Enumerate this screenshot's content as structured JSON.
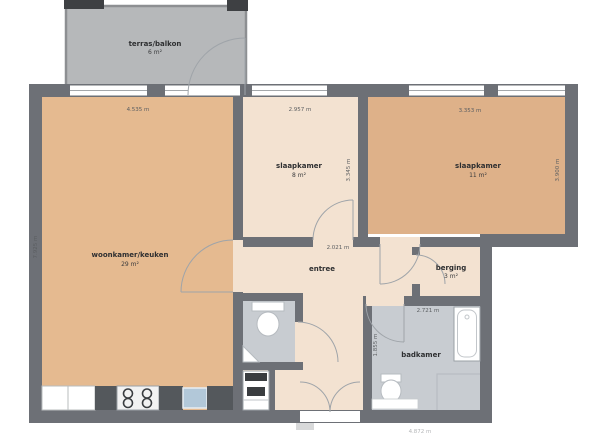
{
  "title": "apartment floor plan",
  "colors": {
    "wall": "#6d7076",
    "balcony_fill": "#b6b8ba",
    "balcony_stroke": "#8d8f92",
    "stub": "#3e4043",
    "living_floor": "#e5ba90",
    "bedroom_right_floor": "#deb189",
    "cream_floor": "#f3e2d1",
    "wet_floor": "#c8ccd1",
    "window_line": "#a4a8ab",
    "door_arc": "#9fa4a9",
    "counter_dark": "#54585c",
    "sink_fill": "#b2c8d9",
    "fixture_stroke": "#9aa0a5",
    "dark_appliance": "#3a3d40"
  },
  "rooms": {
    "balcony": {
      "label": "terras/balkon",
      "area": "6 m²"
    },
    "living": {
      "label": "woonkamer/keuken",
      "area": "29 m²"
    },
    "bedroom_mid": {
      "label": "slaapkamer",
      "area": "8 m²"
    },
    "bedroom_right": {
      "label": "slaapkamer",
      "area": "11 m²"
    },
    "hall": {
      "label": "entree"
    },
    "storage": {
      "label": "berging",
      "area": "3 m²"
    },
    "bathroom": {
      "label": "badkamer"
    }
  },
  "dimensions": {
    "living_width": "4.535 m",
    "living_height": "7.925 m",
    "bedroom_mid_width": "2.957 m",
    "bedroom_mid_height": "3.345 m",
    "bedroom_right_width": "3.353 m",
    "bedroom_right_height": "3.900 m",
    "hall_width": "2.021 m",
    "bathroom_width": "2.721 m",
    "bathroom_height": "1.855 m",
    "bottom_width": "4.872 m"
  }
}
